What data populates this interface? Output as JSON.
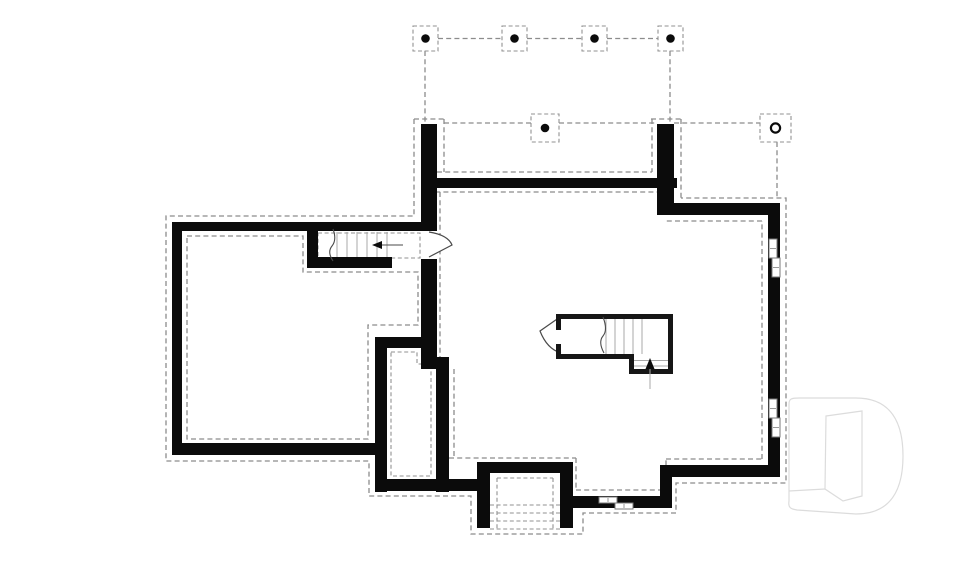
{
  "document": {
    "kind": "basement foundation floor plan",
    "canvas": {
      "width": 960,
      "height": 569,
      "background": "#ffffff"
    },
    "palette": {
      "wall": "#0b0b0b",
      "footing_dash": "#8c8c8c",
      "stair_tread": "#a8a8a8",
      "annotation": "#4a4a4a",
      "window_frame": "#7a7a7a",
      "watermark": "#dcdcdc"
    }
  },
  "layers": [
    {
      "name": "column-grid",
      "items": [
        {
          "t": "line",
          "c": "dash",
          "n": "grid-line",
          "x1": 438,
          "y1": 38.5,
          "x2": 502,
          "y2": 38.5
        },
        {
          "t": "line",
          "c": "dash",
          "n": "grid-line",
          "x1": 527,
          "y1": 38.5,
          "x2": 582,
          "y2": 38.5
        },
        {
          "t": "line",
          "c": "dash",
          "n": "grid-line",
          "x1": 607,
          "y1": 38.5,
          "x2": 658,
          "y2": 38.5
        },
        {
          "t": "line",
          "c": "dash",
          "n": "grid-line",
          "x1": 425,
          "y1": 51,
          "x2": 425,
          "y2": 124
        },
        {
          "t": "line",
          "c": "dash",
          "n": "grid-line",
          "x1": 670,
          "y1": 51,
          "x2": 670,
          "y2": 124
        },
        {
          "t": "rect",
          "c": "dashfine",
          "n": "column-pad",
          "x": 413,
          "y": 26,
          "w": 25,
          "h": 25
        },
        {
          "t": "rect",
          "c": "dashfine",
          "n": "column-pad",
          "x": 502,
          "y": 26,
          "w": 25,
          "h": 25
        },
        {
          "t": "rect",
          "c": "dashfine",
          "n": "column-pad",
          "x": 582,
          "y": 26,
          "w": 25,
          "h": 25
        },
        {
          "t": "rect",
          "c": "dashfine",
          "n": "column-pad",
          "x": 658,
          "y": 26,
          "w": 25,
          "h": 25
        },
        {
          "t": "circle",
          "c": "dot",
          "n": "column-dot",
          "cx": 425.5,
          "cy": 38.5,
          "r": 4.3
        },
        {
          "t": "circle",
          "c": "dot",
          "n": "column-dot",
          "cx": 514.5,
          "cy": 38.5,
          "r": 4.3
        },
        {
          "t": "circle",
          "c": "dot",
          "n": "column-dot",
          "cx": 594.5,
          "cy": 38.5,
          "r": 4.3
        },
        {
          "t": "circle",
          "c": "dot",
          "n": "column-dot",
          "cx": 670.5,
          "cy": 38.5,
          "r": 4.3
        }
      ]
    },
    {
      "name": "porch-footings",
      "items": [
        {
          "t": "line",
          "c": "dash",
          "n": "porch-edge",
          "x1": 444,
          "y1": 123,
          "x2": 531,
          "y2": 123
        },
        {
          "t": "line",
          "c": "dash",
          "n": "porch-edge",
          "x1": 559,
          "y1": 123,
          "x2": 657,
          "y2": 123
        },
        {
          "t": "line",
          "c": "dash",
          "n": "porch-edge",
          "x1": 674,
          "y1": 123,
          "x2": 760,
          "y2": 123
        },
        {
          "t": "line",
          "c": "dash",
          "n": "pier-footing",
          "x1": 414,
          "y1": 119,
          "x2": 444,
          "y2": 119
        },
        {
          "t": "line",
          "c": "dash",
          "n": "pier-footing",
          "x1": 651,
          "y1": 119,
          "x2": 681,
          "y2": 119
        },
        {
          "t": "line",
          "c": "dash",
          "n": "pier-footing",
          "x1": 444,
          "y1": 119,
          "x2": 444,
          "y2": 172
        },
        {
          "t": "line",
          "c": "dash",
          "n": "pier-footing",
          "x1": 652,
          "y1": 119,
          "x2": 652,
          "y2": 172
        },
        {
          "t": "line",
          "c": "dash",
          "n": "pier-footing",
          "x1": 681,
          "y1": 119,
          "x2": 681,
          "y2": 198
        },
        {
          "t": "line",
          "c": "dash",
          "n": "porch-inner-edge",
          "x1": 437,
          "y1": 172,
          "x2": 652,
          "y2": 172
        },
        {
          "t": "line",
          "c": "dash",
          "n": "porch-wall-footing",
          "x1": 427,
          "y1": 192,
          "x2": 662,
          "y2": 192
        },
        {
          "t": "line",
          "c": "dash",
          "n": "column-drop-line",
          "x1": 777,
          "y1": 142,
          "x2": 777,
          "y2": 198
        },
        {
          "t": "rect",
          "c": "dashfine",
          "n": "porch-column-pad",
          "x": 531,
          "y": 114,
          "w": 28,
          "h": 28
        },
        {
          "t": "circle",
          "c": "dot",
          "n": "porch-column-dot",
          "cx": 545,
          "cy": 128,
          "r": 4.3
        },
        {
          "t": "rect",
          "c": "dashfine",
          "n": "corner-column-pad",
          "x": 760,
          "y": 114,
          "w": 31,
          "h": 28
        },
        {
          "t": "circle",
          "c": "ring",
          "n": "corner-column-ring",
          "cx": 775.5,
          "cy": 128,
          "r": 4.6
        }
      ]
    },
    {
      "name": "footings-outer",
      "items": [
        {
          "t": "path",
          "c": "dash",
          "n": "outer-footing-outline",
          "d": "M414,119 L414,216 L166,216 L166,461 L369,461 L369,496 L471,496 L471,534 L583,534 L583,513 L676,513 L676,483 L786,483 L786,198 L681,198"
        }
      ]
    },
    {
      "name": "footings-inner",
      "items": [
        {
          "t": "path",
          "c": "dash",
          "n": "left-room-inner-footing",
          "d": "M187,236 L303,236 L303,272 L418,272 L418,325 L368,325 L368,439 L187,439 Z"
        },
        {
          "t": "path",
          "c": "dashfine",
          "n": "stair-passage-footing",
          "d": "M318,233 H420 V258 H318 Z"
        },
        {
          "t": "path",
          "c": "dashfine",
          "n": "chase-inner-footing",
          "d": "M391,352 L417,352 L417,364 L431,364 L431,476 L391,476 Z"
        },
        {
          "t": "path",
          "c": "dash",
          "n": "main-inner-footing",
          "d": "M440,192 V357 M454,369 V458 M449,458 H576 M576,458 V490 M576,490 H666 M666,490 V459 M666,459 H762 M762,459 V221 M762,221 H666"
        },
        {
          "t": "path",
          "c": "dashfine",
          "n": "areaway-steps",
          "d": "M490,505 H560 M490,513 H560 M490,521 H560 M490,529 H560 M497,478 V530 M553,478 V530 M497,478 H553"
        }
      ]
    },
    {
      "name": "foundation-walls",
      "items": [
        {
          "t": "rect",
          "c": "wall",
          "n": "wall-west-upper",
          "x": 421,
          "y": 124,
          "w": 16,
          "h": 107
        },
        {
          "t": "rect",
          "c": "wall",
          "n": "wall-west-mid",
          "x": 421,
          "y": 259,
          "w": 16,
          "h": 100
        },
        {
          "t": "rect",
          "c": "wall",
          "n": "wall-west-jog",
          "x": 421,
          "y": 357,
          "w": 28,
          "h": 12
        },
        {
          "t": "rect",
          "c": "wall",
          "n": "wall-west-lower",
          "x": 436,
          "y": 357,
          "w": 13,
          "h": 135
        },
        {
          "t": "rect",
          "c": "wall",
          "n": "wall-chase-left",
          "x": 375,
          "y": 337,
          "w": 12,
          "h": 155
        },
        {
          "t": "rect",
          "c": "wall",
          "n": "wall-chase-top",
          "x": 375,
          "y": 337,
          "w": 52,
          "h": 11
        },
        {
          "t": "rect",
          "c": "wall",
          "n": "wall-chase-bottom",
          "x": 375,
          "y": 479,
          "w": 74,
          "h": 12
        },
        {
          "t": "rect",
          "c": "wall",
          "n": "wall-south-seg-a",
          "x": 449,
          "y": 479,
          "w": 35,
          "h": 12
        },
        {
          "t": "rect",
          "c": "wall",
          "n": "wall-leftroom-left",
          "x": 172,
          "y": 222,
          "w": 10,
          "h": 233
        },
        {
          "t": "rect",
          "c": "wall",
          "n": "wall-leftroom-top",
          "x": 172,
          "y": 222,
          "w": 265,
          "h": 9
        },
        {
          "t": "rect",
          "c": "wall",
          "n": "wall-leftroom-bottom",
          "x": 172,
          "y": 443,
          "w": 212,
          "h": 12
        },
        {
          "t": "rect",
          "c": "wall",
          "n": "wall-stair-west-end",
          "x": 307,
          "y": 222,
          "w": 11,
          "h": 46
        },
        {
          "t": "rect",
          "c": "wall",
          "n": "wall-stair-south",
          "x": 307,
          "y": 257,
          "w": 85,
          "h": 11
        },
        {
          "t": "rect",
          "c": "wall",
          "n": "wall-porch-front",
          "x": 421,
          "y": 178,
          "w": 256,
          "h": 10
        },
        {
          "t": "rect",
          "c": "wall",
          "n": "wall-porch-right-pier",
          "x": 657,
          "y": 124,
          "w": 17,
          "h": 91
        },
        {
          "t": "rect",
          "c": "wall",
          "n": "wall-top-right",
          "x": 657,
          "y": 203,
          "w": 123,
          "h": 12
        },
        {
          "t": "rect",
          "c": "wall",
          "n": "wall-east",
          "x": 768,
          "y": 203,
          "w": 12,
          "h": 274
        },
        {
          "t": "rect",
          "c": "wall",
          "n": "wall-southeast",
          "x": 672,
          "y": 465,
          "w": 108,
          "h": 12
        },
        {
          "t": "rect",
          "c": "wall",
          "n": "wall-se-step",
          "x": 660,
          "y": 465,
          "w": 12,
          "h": 43
        },
        {
          "t": "rect",
          "c": "wall",
          "n": "wall-south-seg-b",
          "x": 566,
          "y": 496,
          "w": 106,
          "h": 12
        },
        {
          "t": "rect",
          "c": "wall",
          "n": "wall-areaway-left",
          "x": 477,
          "y": 462,
          "w": 13,
          "h": 66
        },
        {
          "t": "rect",
          "c": "wall",
          "n": "wall-areaway-top",
          "x": 477,
          "y": 462,
          "w": 96,
          "h": 11
        },
        {
          "t": "rect",
          "c": "wall",
          "n": "wall-areaway-right",
          "x": 560,
          "y": 462,
          "w": 13,
          "h": 66
        }
      ]
    },
    {
      "name": "stair-passage",
      "items": [
        {
          "t": "line",
          "c": "tread",
          "n": "stair-tread",
          "x1": 337,
          "y1": 232,
          "x2": 337,
          "y2": 257
        },
        {
          "t": "line",
          "c": "tread",
          "n": "stair-tread",
          "x1": 347,
          "y1": 232,
          "x2": 347,
          "y2": 257
        },
        {
          "t": "line",
          "c": "tread",
          "n": "stair-tread",
          "x1": 357,
          "y1": 232,
          "x2": 357,
          "y2": 257
        },
        {
          "t": "line",
          "c": "tread",
          "n": "stair-tread",
          "x1": 367,
          "y1": 232,
          "x2": 367,
          "y2": 257
        },
        {
          "t": "line",
          "c": "tread",
          "n": "stair-tread",
          "x1": 377,
          "y1": 232,
          "x2": 377,
          "y2": 257
        },
        {
          "t": "line",
          "c": "tread",
          "n": "stair-tread",
          "x1": 387,
          "y1": 232,
          "x2": 387,
          "y2": 257
        },
        {
          "t": "path",
          "c": "thin",
          "n": "stair-break-line",
          "d": "M333,229 Q337,240 332,246 Q327,252 333,261"
        },
        {
          "t": "line",
          "c": "thin",
          "n": "stair-direction-line",
          "x1": 381,
          "y1": 245,
          "x2": 403,
          "y2": 245
        },
        {
          "t": "polygon",
          "c": "dot",
          "n": "stair-direction-arrowhead",
          "p": "372,245 382,241 382,249"
        },
        {
          "t": "path",
          "c": "door",
          "n": "door-swing-stair-passage",
          "d": "M429,232 Q448,235 452,245 L429,257"
        }
      ]
    },
    {
      "name": "stair-central",
      "items": [
        {
          "t": "path",
          "c": "door",
          "n": "door-swing-central-stair",
          "d": "M560,317 L540,331 Q547,349 561,353"
        },
        {
          "t": "rect",
          "c": "stairwall",
          "n": "stairwell-wall-top",
          "x": 556,
          "y": 314,
          "w": 117,
          "h": 5
        },
        {
          "t": "rect",
          "c": "stairwall",
          "n": "stairwell-wall-right",
          "x": 668,
          "y": 314,
          "w": 5,
          "h": 60
        },
        {
          "t": "rect",
          "c": "stairwall",
          "n": "stairwell-wall-left-a",
          "x": 556,
          "y": 314,
          "w": 5,
          "h": 16
        },
        {
          "t": "rect",
          "c": "stairwall",
          "n": "stairwell-wall-left-b",
          "x": 556,
          "y": 344,
          "w": 5,
          "h": 15
        },
        {
          "t": "rect",
          "c": "stairwall",
          "n": "stairwell-wall-bottom-left",
          "x": 556,
          "y": 354,
          "w": 78,
          "h": 5
        },
        {
          "t": "rect",
          "c": "stairwall",
          "n": "stairwell-wall-mid",
          "x": 629,
          "y": 354,
          "w": 5,
          "h": 20
        },
        {
          "t": "rect",
          "c": "stairwall",
          "n": "stairwell-wall-bottom-right",
          "x": 629,
          "y": 369,
          "w": 44,
          "h": 5
        },
        {
          "t": "line",
          "c": "tread",
          "n": "stair-tread",
          "x1": 606,
          "y1": 319,
          "x2": 606,
          "y2": 354
        },
        {
          "t": "line",
          "c": "tread",
          "n": "stair-tread",
          "x1": 615,
          "y1": 319,
          "x2": 615,
          "y2": 354
        },
        {
          "t": "line",
          "c": "tread",
          "n": "stair-tread",
          "x1": 624,
          "y1": 319,
          "x2": 624,
          "y2": 354
        },
        {
          "t": "line",
          "c": "tread",
          "n": "stair-tread",
          "x1": 633,
          "y1": 319,
          "x2": 633,
          "y2": 354
        },
        {
          "t": "line",
          "c": "tread",
          "n": "stair-tread",
          "x1": 642,
          "y1": 319,
          "x2": 642,
          "y2": 354
        },
        {
          "t": "line",
          "c": "tread",
          "n": "stair-tread",
          "x1": 634,
          "y1": 360.5,
          "x2": 668,
          "y2": 360.5
        },
        {
          "t": "line",
          "c": "tread",
          "n": "stair-tread",
          "x1": 634,
          "y1": 366,
          "x2": 668,
          "y2": 366
        },
        {
          "t": "path",
          "c": "thin",
          "n": "stair-break-line",
          "d": "M603,317 Q608,330 603,336 Q598,342 604,353"
        },
        {
          "t": "line",
          "c": "tread",
          "n": "stair-direction-line",
          "x1": 650,
          "y1": 364,
          "x2": 650,
          "y2": 389
        },
        {
          "t": "polygon",
          "c": "dot",
          "n": "stair-direction-arrowhead",
          "p": "650,358 645.5,369 654.5,369"
        }
      ]
    },
    {
      "name": "windows",
      "items": [
        {
          "t": "rect",
          "c": "win",
          "n": "window-east-upper-sash",
          "x": 769,
          "y": 239,
          "w": 8,
          "h": 19
        },
        {
          "t": "rect",
          "c": "win",
          "n": "window-east-upper-sash",
          "x": 772,
          "y": 258,
          "w": 8,
          "h": 19
        },
        {
          "t": "line",
          "c": "wintick",
          "n": "window-tick",
          "x1": 770,
          "y1": 248.5,
          "x2": 776,
          "y2": 248.5
        },
        {
          "t": "line",
          "c": "wintick",
          "n": "window-tick",
          "x1": 773,
          "y1": 267.5,
          "x2": 779,
          "y2": 267.5
        },
        {
          "t": "rect",
          "c": "win",
          "n": "window-east-lower-sash",
          "x": 769,
          "y": 399,
          "w": 8,
          "h": 19
        },
        {
          "t": "rect",
          "c": "win",
          "n": "window-east-lower-sash",
          "x": 772,
          "y": 418,
          "w": 8,
          "h": 19
        },
        {
          "t": "line",
          "c": "wintick",
          "n": "window-tick",
          "x1": 770,
          "y1": 408.5,
          "x2": 776,
          "y2": 408.5
        },
        {
          "t": "line",
          "c": "wintick",
          "n": "window-tick",
          "x1": 773,
          "y1": 427.5,
          "x2": 779,
          "y2": 427.5
        },
        {
          "t": "rect",
          "c": "win",
          "n": "window-south-sash",
          "x": 599,
          "y": 497,
          "w": 18,
          "h": 6
        },
        {
          "t": "rect",
          "c": "win",
          "n": "window-south-sash",
          "x": 615,
          "y": 503,
          "w": 18,
          "h": 6
        },
        {
          "t": "line",
          "c": "wintick",
          "n": "window-tick",
          "x1": 608,
          "y1": 498,
          "x2": 608,
          "y2": 502
        },
        {
          "t": "line",
          "c": "wintick",
          "n": "window-tick",
          "x1": 624,
          "y1": 504,
          "x2": 624,
          "y2": 508
        }
      ]
    },
    {
      "name": "watermark",
      "items": [
        {
          "t": "path",
          "c": "wm",
          "n": "watermark-d-outer",
          "d": "M789,404 C789,399 791,398 799,398 L856,398 C892,398 903,424 903,456 C903,488 892,514 856,514 L797,510 C790,509 788,507 789,501 Z"
        },
        {
          "t": "path",
          "c": "wm",
          "n": "watermark-d-inner",
          "d": "M826,416 L862,411 L862,496 L843,501 L825,489 Z"
        },
        {
          "t": "line",
          "c": "wm",
          "n": "watermark-d-base-line",
          "x1": 789,
          "y1": 491,
          "x2": 825,
          "y2": 489
        }
      ]
    }
  ]
}
